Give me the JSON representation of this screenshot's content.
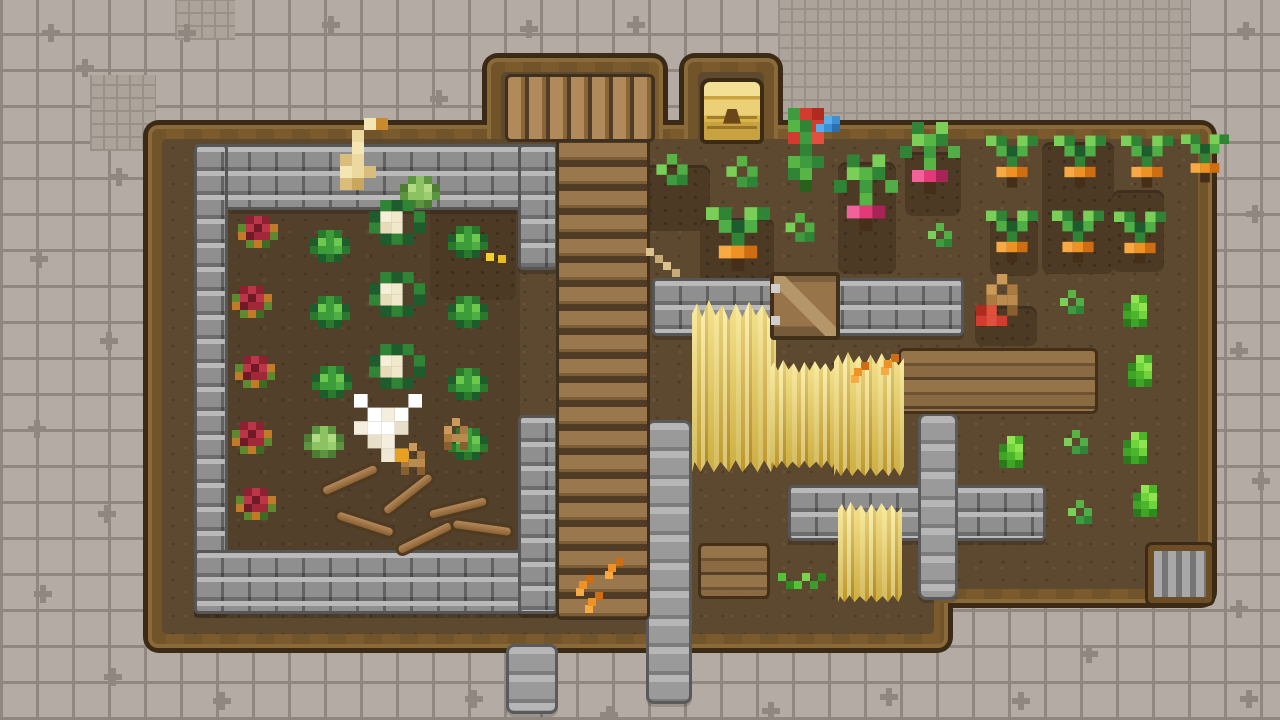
{
  "canvas": {
    "width": 1280,
    "height": 720
  },
  "palette": {
    "tile_base": "#b4aca4",
    "tile_line": "#8f8780",
    "fine_tile_base": "#aca49b",
    "farm_outline": "#3a2a16",
    "farm_wood": "#7b5a2d",
    "farm_dirt": "#5d4830",
    "stone_wall": "#8f8f8f",
    "stone_path": "#a0a0a0",
    "plank": "#8a6a42",
    "wheat_gold": "#e8cc54",
    "chest_gold": "#ecd077",
    "cabbage_green": "#3c9d3a",
    "cauliflower_cream": "#f0e8cb",
    "red_crop": "#a02838",
    "carrot_orange": "#ef9226",
    "radish_pink": "#e23a78",
    "bush_green": "#4db52c"
  },
  "background": {
    "grid_cell": 36,
    "fine_grid_cell": 13,
    "fine_grid_regions": [
      {
        "x": 778,
        "y": 0,
        "w": 412,
        "h": 166
      },
      {
        "x": 90,
        "y": 75,
        "w": 66,
        "h": 76
      },
      {
        "x": 175,
        "y": 0,
        "w": 60,
        "h": 40
      }
    ],
    "plus_marks": [
      [
        42,
        24
      ],
      [
        178,
        24
      ],
      [
        76,
        59
      ],
      [
        322,
        16
      ],
      [
        430,
        90
      ],
      [
        520,
        20
      ],
      [
        627,
        16
      ],
      [
        1237,
        22
      ],
      [
        110,
        168
      ],
      [
        30,
        250
      ],
      [
        100,
        332
      ],
      [
        28,
        420
      ],
      [
        98,
        505
      ],
      [
        34,
        585
      ],
      [
        104,
        668
      ],
      [
        213,
        692
      ],
      [
        465,
        690
      ],
      [
        600,
        706
      ],
      [
        762,
        702
      ],
      [
        880,
        688
      ],
      [
        1012,
        692
      ],
      [
        1240,
        690
      ],
      [
        1246,
        205
      ],
      [
        1230,
        342
      ],
      [
        1252,
        472
      ],
      [
        1230,
        600
      ],
      [
        1080,
        645
      ]
    ]
  },
  "farm": {
    "rects": [
      {
        "name": "main-field",
        "x": 148,
        "y": 125,
        "w": 800,
        "h": 523
      },
      {
        "name": "right-field",
        "x": 912,
        "y": 125,
        "w": 300,
        "h": 478
      },
      {
        "name": "north-log-path",
        "x": 487,
        "y": 58,
        "w": 176,
        "h": 100
      },
      {
        "name": "chest-alcove",
        "x": 684,
        "y": 58,
        "w": 94,
        "h": 100
      }
    ]
  },
  "terrain": [
    {
      "type": "shade",
      "name": "garden-soil-shade",
      "x": 228,
      "y": 210,
      "w": 292,
      "h": 346
    },
    {
      "type": "dirtpatch",
      "name": "tilled-soil",
      "x": 430,
      "y": 188,
      "w": 86,
      "h": 112
    },
    {
      "type": "dirtpatch",
      "name": "tilled-soil",
      "x": 628,
      "y": 165,
      "w": 82,
      "h": 66
    },
    {
      "type": "dirtpatch",
      "name": "tilled-soil",
      "x": 700,
      "y": 218,
      "w": 74,
      "h": 86
    },
    {
      "type": "dirtpatch",
      "name": "tilled-soil",
      "x": 838,
      "y": 162,
      "w": 58,
      "h": 112
    },
    {
      "type": "dirtpatch",
      "name": "tilled-soil",
      "x": 905,
      "y": 152,
      "w": 56,
      "h": 64
    },
    {
      "type": "dirtpatch",
      "name": "tilled-soil",
      "x": 975,
      "y": 306,
      "w": 62,
      "h": 40
    },
    {
      "type": "dirtpatch",
      "name": "tilled-soil",
      "x": 1042,
      "y": 142,
      "w": 72,
      "h": 132
    },
    {
      "type": "dirtpatch",
      "name": "tilled-soil",
      "x": 1112,
      "y": 190,
      "w": 52,
      "h": 82
    },
    {
      "type": "dirtpatch",
      "name": "tilled-soil",
      "x": 990,
      "y": 218,
      "w": 48,
      "h": 58
    },
    {
      "type": "wall",
      "name": "garden-wall-top",
      "x": 194,
      "y": 144,
      "w": 364,
      "h": 66
    },
    {
      "type": "wall",
      "name": "garden-wall-left",
      "x": 194,
      "y": 144,
      "w": 34,
      "h": 470
    },
    {
      "type": "wall",
      "name": "garden-wall-bottom",
      "x": 194,
      "y": 550,
      "w": 364,
      "h": 64
    },
    {
      "type": "wall",
      "name": "garden-wall-right-upper",
      "x": 518,
      "y": 144,
      "w": 40,
      "h": 126
    },
    {
      "type": "wall",
      "name": "garden-wall-right-lower",
      "x": 518,
      "y": 415,
      "w": 40,
      "h": 199
    },
    {
      "type": "wall",
      "name": "field-wall-north",
      "x": 652,
      "y": 278,
      "w": 312,
      "h": 58
    },
    {
      "type": "wall",
      "name": "field-wall-south",
      "x": 788,
      "y": 485,
      "w": 258,
      "h": 56
    },
    {
      "type": "pillar",
      "name": "stone-path-vertical-right",
      "x": 918,
      "y": 413,
      "w": 40,
      "h": 187
    },
    {
      "type": "pillar",
      "name": "stone-path-vertical-center",
      "x": 646,
      "y": 420,
      "w": 46,
      "h": 284
    },
    {
      "type": "pillar",
      "name": "stone-path-south-exit",
      "x": 506,
      "y": 644,
      "w": 52,
      "h": 70
    },
    {
      "type": "planksv",
      "name": "plank-path",
      "x": 556,
      "y": 138,
      "w": 94,
      "h": 482
    },
    {
      "type": "logsh",
      "name": "log-path",
      "x": 505,
      "y": 74,
      "w": 150,
      "h": 68
    },
    {
      "type": "plankpatch",
      "name": "plank-platform",
      "x": 898,
      "y": 348,
      "w": 200,
      "h": 66
    },
    {
      "type": "plankpatch",
      "name": "plank-platform",
      "x": 698,
      "y": 543,
      "w": 72,
      "h": 56
    }
  ],
  "wheat": [
    {
      "x": 692,
      "y": 300,
      "w": 84,
      "h": 172
    },
    {
      "x": 770,
      "y": 360,
      "w": 66,
      "h": 108
    },
    {
      "x": 834,
      "y": 352,
      "w": 70,
      "h": 124
    },
    {
      "x": 838,
      "y": 502,
      "w": 64,
      "h": 100
    }
  ],
  "structures": [
    {
      "type": "chest",
      "name": "treasure-chest",
      "x": 700,
      "y": 78,
      "w": 64,
      "h": 66
    },
    {
      "type": "gate",
      "name": "wooden-gate",
      "x": 770,
      "y": 272,
      "w": 70,
      "h": 68
    },
    {
      "type": "grate",
      "name": "drain-grate",
      "x": 1148,
      "y": 545,
      "w": 64,
      "h": 58
    }
  ],
  "entities": [
    {
      "type": "red",
      "name": "red-cabbage-crop",
      "x": 258,
      "y": 236
    },
    {
      "type": "red",
      "name": "red-cabbage-crop",
      "x": 252,
      "y": 306
    },
    {
      "type": "red",
      "name": "red-cabbage-crop",
      "x": 255,
      "y": 376
    },
    {
      "type": "red",
      "name": "red-cabbage-crop",
      "x": 252,
      "y": 442
    },
    {
      "type": "red",
      "name": "red-cabbage-crop",
      "x": 256,
      "y": 508
    },
    {
      "type": "cabbage",
      "name": "cabbage-crop",
      "x": 330,
      "y": 250
    },
    {
      "type": "cabbage",
      "name": "cabbage-crop",
      "x": 468,
      "y": 246
    },
    {
      "type": "cabbage",
      "name": "cabbage-crop",
      "x": 330,
      "y": 316
    },
    {
      "type": "cabbage",
      "name": "cabbage-crop",
      "x": 468,
      "y": 316
    },
    {
      "type": "cabbage",
      "name": "cabbage-crop",
      "x": 332,
      "y": 386
    },
    {
      "type": "cabbage",
      "name": "cabbage-crop",
      "x": 468,
      "y": 388
    },
    {
      "type": "cabbage",
      "name": "cabbage-crop",
      "x": 468,
      "y": 448
    },
    {
      "type": "cabbagelight",
      "name": "light-cabbage-crop",
      "x": 420,
      "y": 196
    },
    {
      "type": "cabbagelight",
      "name": "light-cabbage-crop",
      "x": 324,
      "y": 446
    },
    {
      "type": "cauliflower",
      "name": "cauliflower-crop",
      "x": 397,
      "y": 228,
      "s": 1.4
    },
    {
      "type": "cauliflower",
      "name": "cauliflower-crop",
      "x": 397,
      "y": 300,
      "s": 1.4
    },
    {
      "type": "cauliflower",
      "name": "cauliflower-crop",
      "x": 397,
      "y": 372,
      "s": 1.4
    },
    {
      "type": "goosecream",
      "name": "cream-goose",
      "x": 358,
      "y": 172,
      "s": 1.5
    },
    {
      "type": "itemyellow",
      "name": "dropped-item",
      "x": 490,
      "y": 257
    },
    {
      "type": "log",
      "name": "wood-log",
      "x": 350,
      "y": 480,
      "r": -24
    },
    {
      "type": "log",
      "name": "wood-log",
      "x": 408,
      "y": 494,
      "r": -38
    },
    {
      "type": "log",
      "name": "wood-log",
      "x": 458,
      "y": 508,
      "r": -14
    },
    {
      "type": "log",
      "name": "wood-log",
      "x": 365,
      "y": 524,
      "r": 18
    },
    {
      "type": "log",
      "name": "wood-log",
      "x": 425,
      "y": 538,
      "r": -26
    },
    {
      "type": "log",
      "name": "wood-log",
      "x": 482,
      "y": 528,
      "r": 8
    },
    {
      "type": "gopher",
      "name": "gopher",
      "x": 413,
      "y": 463
    },
    {
      "type": "gopher",
      "name": "gopher",
      "x": 456,
      "y": 438
    },
    {
      "type": "goosewhite",
      "name": "white-goose",
      "x": 388,
      "y": 428,
      "s": 1.7
    },
    {
      "type": "sprout",
      "name": "sprout-crop",
      "x": 672,
      "y": 180,
      "s": 1.3
    },
    {
      "type": "sprout",
      "name": "sprout-crop",
      "x": 742,
      "y": 182,
      "s": 1.3
    },
    {
      "type": "sprout",
      "name": "sprout-crop",
      "x": 800,
      "y": 237,
      "s": 1.2
    },
    {
      "type": "carrot",
      "name": "carrot-crop",
      "x": 738,
      "y": 252,
      "s": 1.6
    },
    {
      "type": "forage",
      "name": "forage-item",
      "x": 650,
      "y": 252
    },
    {
      "type": "forage",
      "name": "forage-item",
      "x": 667,
      "y": 266
    },
    {
      "type": "tomatoplant",
      "name": "tomato-plant",
      "x": 806,
      "y": 162,
      "s": 1.5
    },
    {
      "type": "bluebird",
      "name": "blue-bird",
      "x": 828,
      "y": 128
    },
    {
      "type": "radish",
      "name": "radish-crop",
      "x": 866,
      "y": 212,
      "s": 1.6
    },
    {
      "type": "radish",
      "name": "radish-crop",
      "x": 930,
      "y": 176,
      "s": 1.5
    },
    {
      "type": "sprout",
      "name": "sprout-crop",
      "x": 940,
      "y": 243
    },
    {
      "type": "itemorange",
      "name": "dropped-item",
      "x": 858,
      "y": 372
    },
    {
      "type": "itemorange",
      "name": "dropped-item",
      "x": 888,
      "y": 364
    },
    {
      "type": "grass",
      "name": "grass-tuft",
      "x": 798,
      "y": 585
    },
    {
      "type": "itemorange",
      "name": "dropped-item",
      "x": 583,
      "y": 585
    },
    {
      "type": "itemorange",
      "name": "dropped-item",
      "x": 612,
      "y": 568
    },
    {
      "type": "itemorange",
      "name": "dropped-item",
      "x": 592,
      "y": 602
    },
    {
      "type": "gopherred",
      "name": "gopher-with-tomato",
      "x": 1002,
      "y": 300,
      "s": 1.3
    },
    {
      "type": "carrot",
      "name": "carrot-crop",
      "x": 1012,
      "y": 172,
      "s": 1.3
    },
    {
      "type": "carrot",
      "name": "carrot-crop",
      "x": 1080,
      "y": 172,
      "s": 1.3
    },
    {
      "type": "carrot",
      "name": "carrot-crop",
      "x": 1147,
      "y": 172,
      "s": 1.3
    },
    {
      "type": "carrot",
      "name": "carrot-crop",
      "x": 1205,
      "y": 168,
      "s": 1.2
    },
    {
      "type": "carrot",
      "name": "carrot-crop",
      "x": 1012,
      "y": 247,
      "s": 1.3
    },
    {
      "type": "carrot",
      "name": "carrot-crop",
      "x": 1078,
      "y": 247,
      "s": 1.3
    },
    {
      "type": "carrot",
      "name": "carrot-crop",
      "x": 1140,
      "y": 248,
      "s": 1.3
    },
    {
      "type": "sprout",
      "name": "sprout-crop",
      "x": 1072,
      "y": 310
    },
    {
      "type": "bush",
      "name": "bush-plant",
      "x": 1135,
      "y": 315
    },
    {
      "type": "bush",
      "name": "bush-plant",
      "x": 1140,
      "y": 375
    },
    {
      "type": "bush",
      "name": "bush-plant",
      "x": 1135,
      "y": 452
    },
    {
      "type": "bush",
      "name": "bush-plant",
      "x": 1011,
      "y": 456
    },
    {
      "type": "bush",
      "name": "bush-plant",
      "x": 1145,
      "y": 505
    },
    {
      "type": "sprout",
      "name": "sprout-crop",
      "x": 1076,
      "y": 450
    },
    {
      "type": "sprout",
      "name": "sprout-crop",
      "x": 1080,
      "y": 520
    }
  ]
}
